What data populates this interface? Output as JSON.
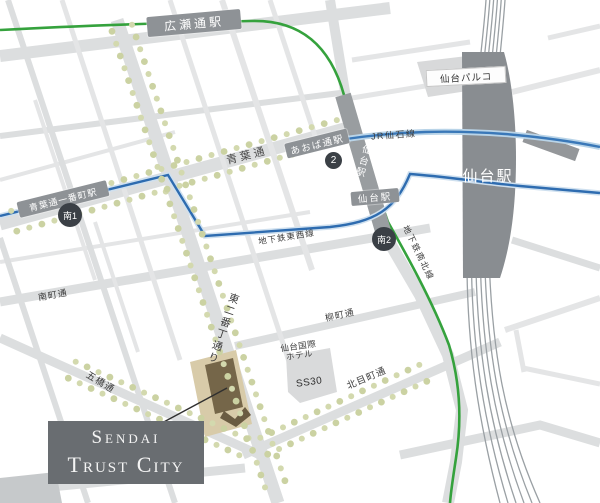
{
  "colors": {
    "road": "#dcdedf",
    "road_thin": "#e4e5e6",
    "station_road_band": "#999da0",
    "station_building": "#898d91",
    "badge_grey": "#8e9296",
    "exit_circle": "#3b4046",
    "subway_namboku_green": "#35a23d",
    "subway_tozai_blue": "#2e6cb0",
    "jr_senseki_blue": "#3a78b8",
    "trees": "#cbd2a2",
    "site_block_beige": "#d8cba9",
    "site_building_brown": "#756649",
    "title_box_grey": "#696d71",
    "rail_track": "#9aa0a4"
  },
  "title_box": {
    "line1": "Sendai",
    "line2": "Trust City"
  },
  "stations": {
    "hirose_dori": "広瀬通駅",
    "aobadori_ichibancho": "青葉通一番町駅",
    "aobadori": "あおば通駅",
    "sendai_road_badge": "仙台駅",
    "sendai_road_vertical": "仙台駅",
    "sendai_terminal": "仙台駅",
    "exit_minami1": "南1",
    "exit_2": "2",
    "exit_minami2": "南2"
  },
  "lines": {
    "jr_senseki": "JR仙石線",
    "subway_tozai": "地下鉄東西線",
    "subway_namboku": "地下鉄南北線"
  },
  "streets": {
    "aoba_dori": "青葉通",
    "minamimachi_dori": "南町通",
    "yanagimachi_dori": "柳町通",
    "kitamemachi_dori": "北目町通",
    "itsutsubashi_dori": "五橋通",
    "higashi_nibancho_dori": "東二番丁通り"
  },
  "landmarks": {
    "sendai_parco": "仙台パルコ",
    "kokusai_hotel_line1": "仙台国際",
    "kokusai_hotel_line2": "ホテル",
    "ss30": "SS30"
  }
}
